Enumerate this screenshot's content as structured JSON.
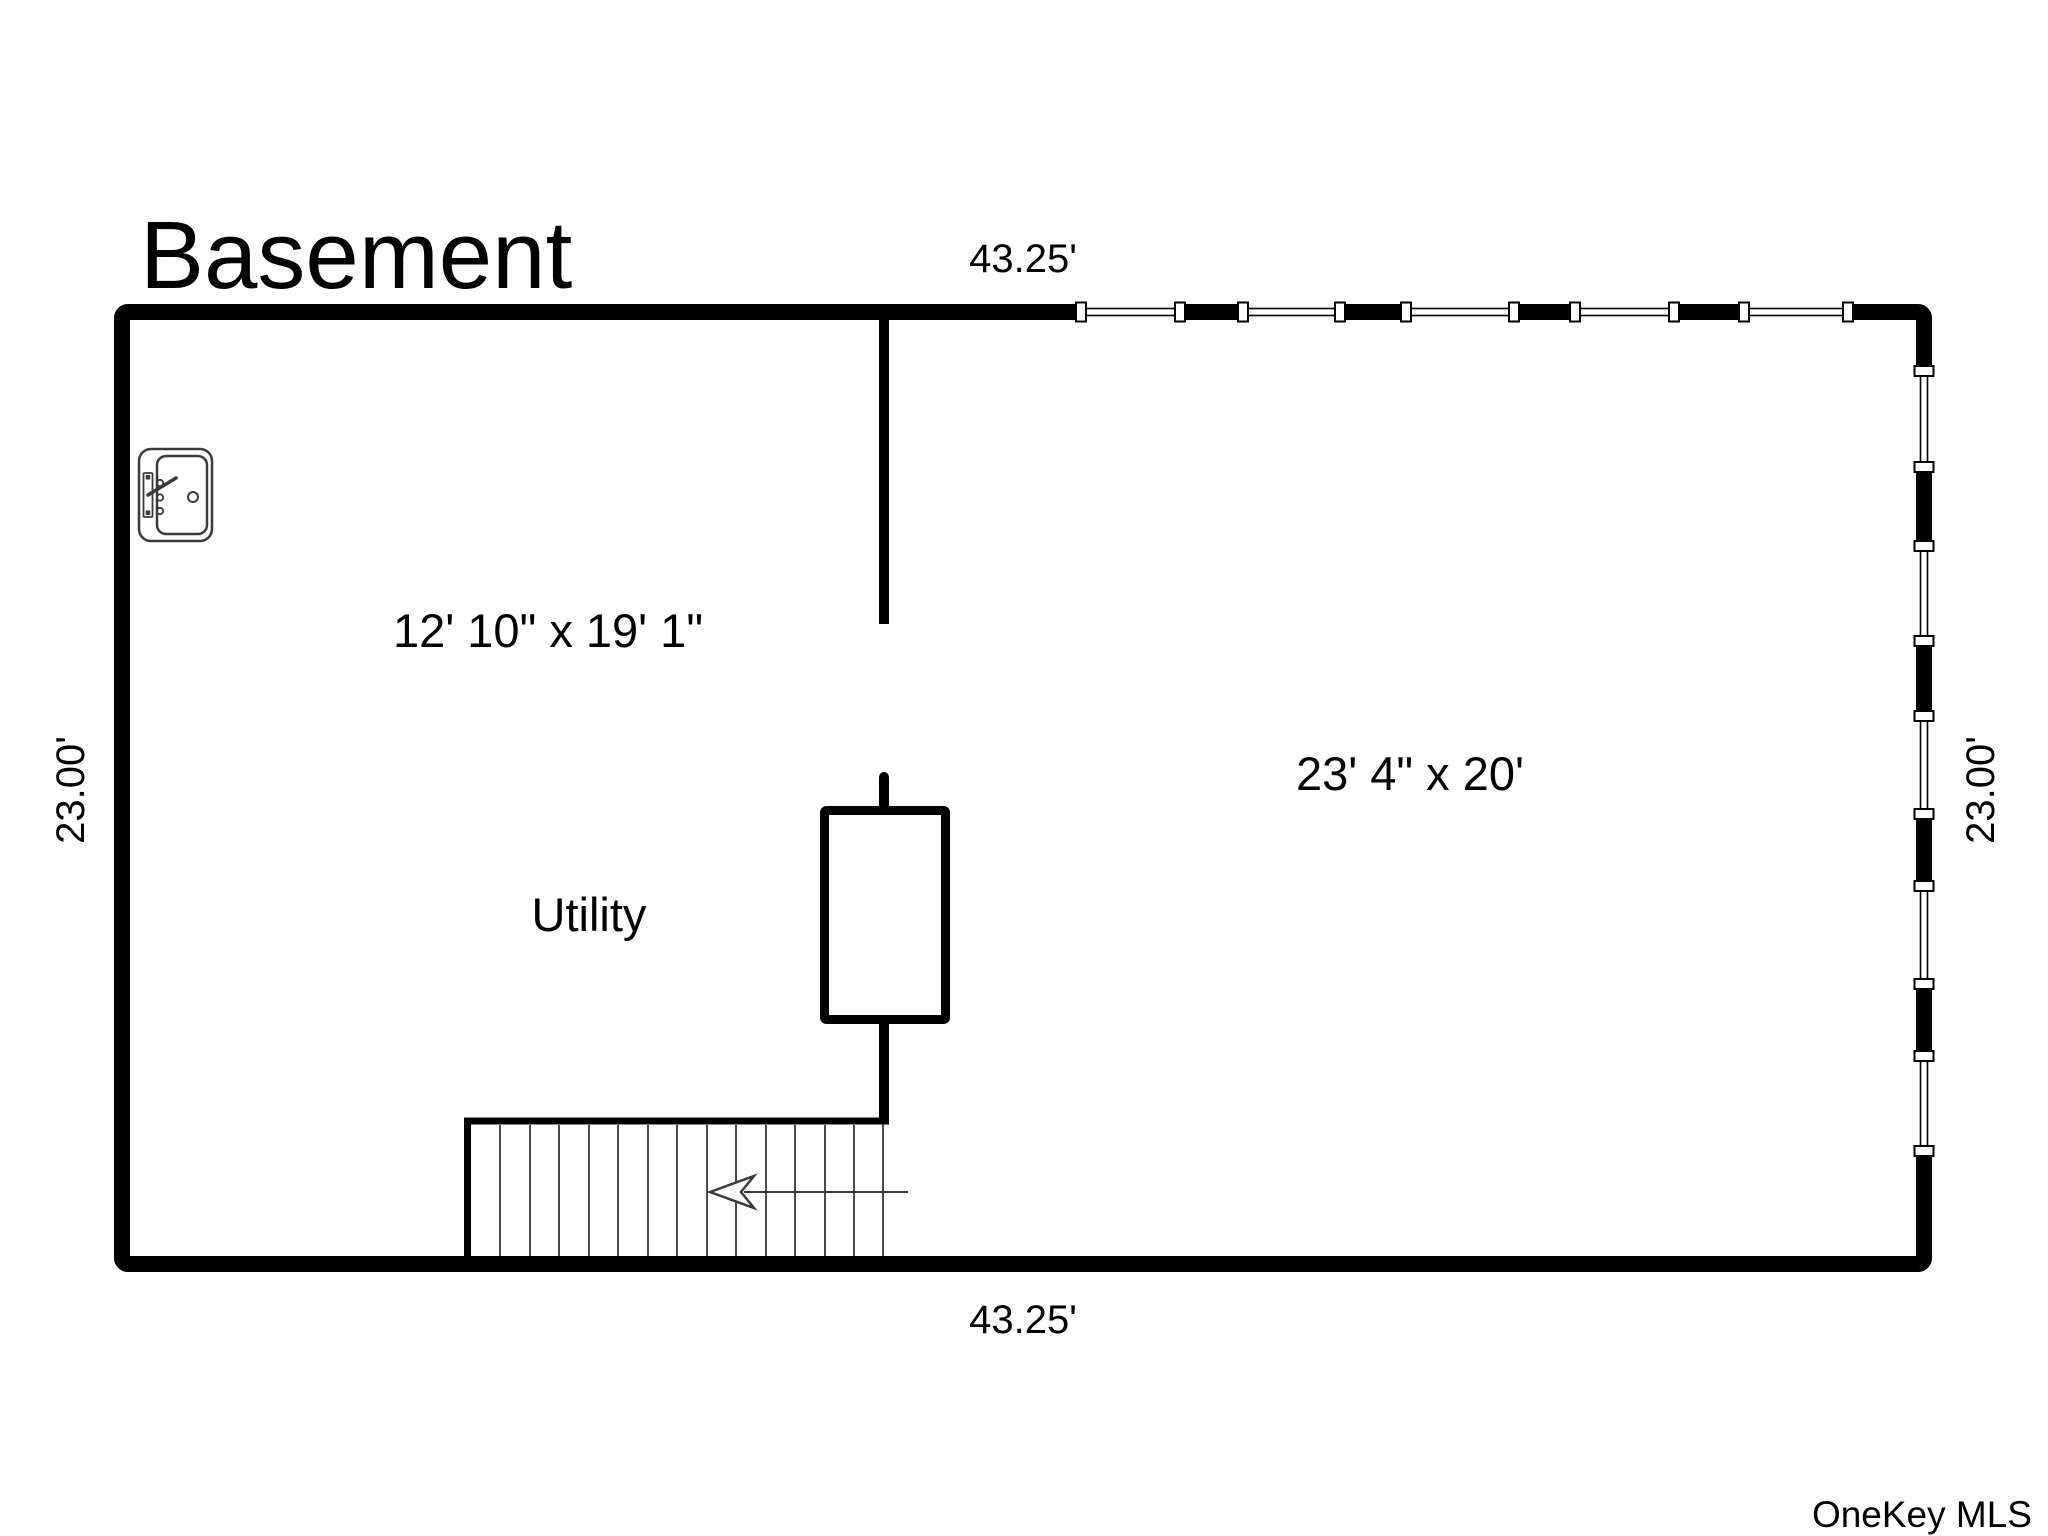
{
  "page": {
    "title": "Basement",
    "watermark": "OneKey MLS"
  },
  "dimensions": {
    "top": "43.25'",
    "bottom": "43.25'",
    "left": "23.00'",
    "right": "23.00'"
  },
  "rooms": {
    "left_room_size": "12' 10\" x 19' 1\"",
    "right_room_size": "23' 4\" x 20'",
    "utility_label": "Utility"
  },
  "fixtures": {
    "sink_icon": "laundry-sink",
    "stairs": "stairs-down-arrow-left",
    "utility_closet": "mechanical-closet",
    "window_count_top": 5,
    "window_count_right": 5
  },
  "colors": {
    "wall": "#000000",
    "text": "#000000",
    "fixture_stroke": "#3a3a3a",
    "stair_line": "#4a4a4a",
    "watermark": "#9b9b9b",
    "background": "#ffffff"
  }
}
